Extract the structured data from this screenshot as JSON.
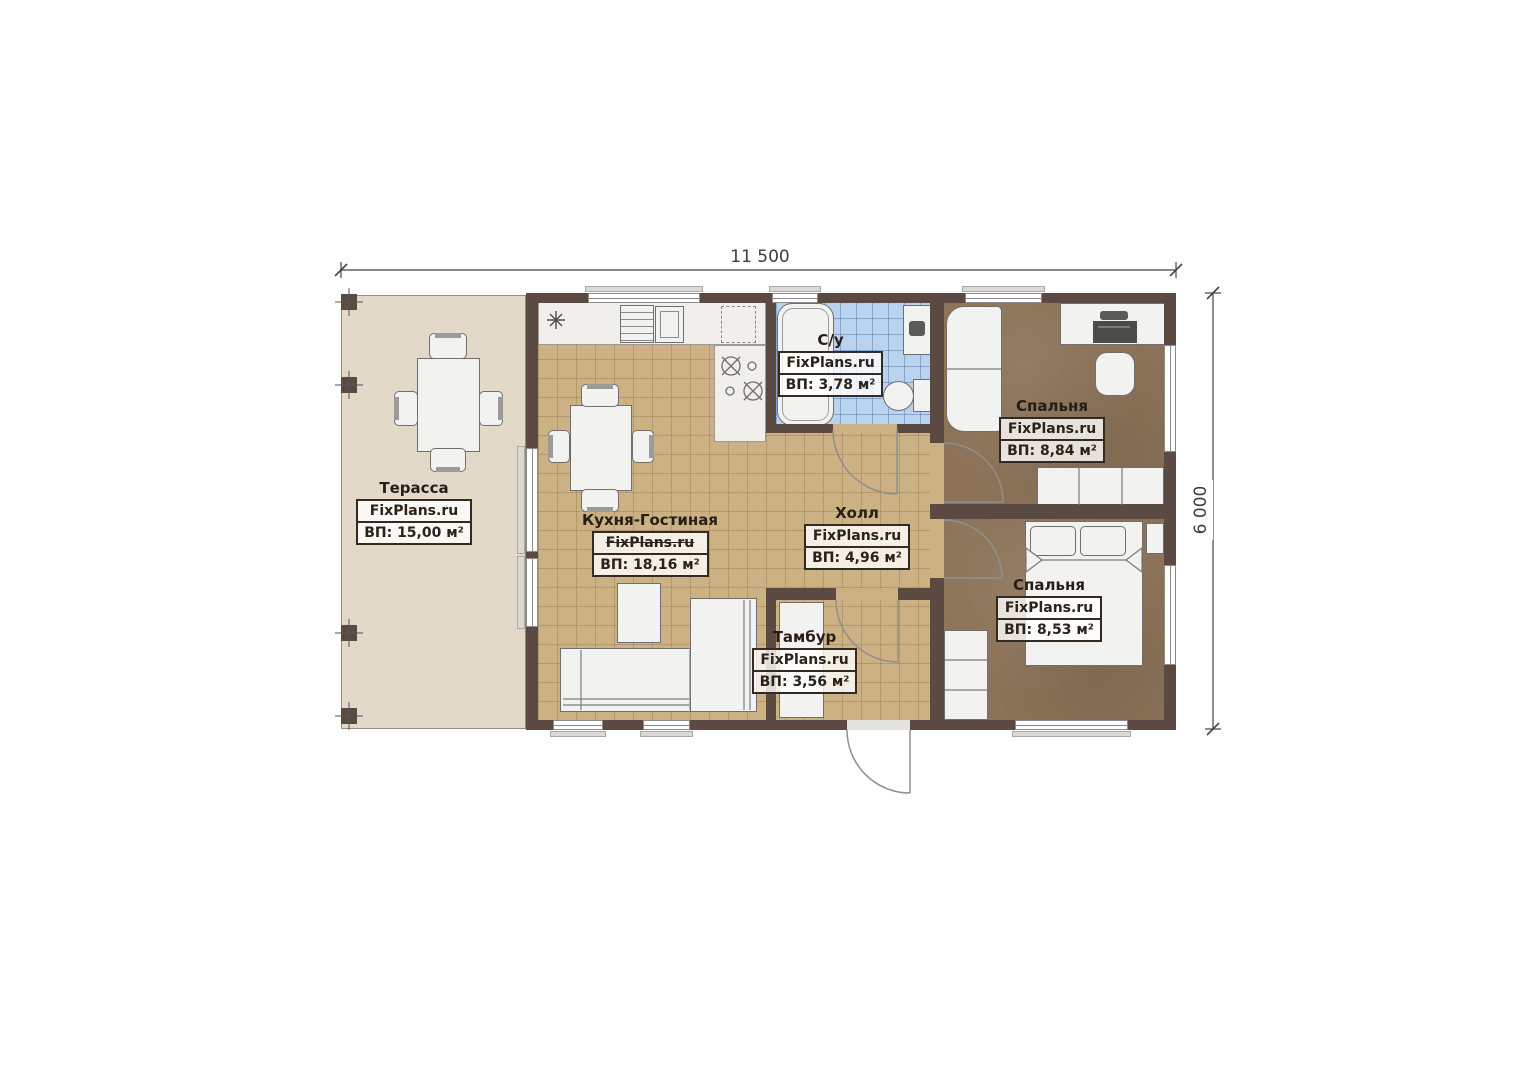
{
  "dimensions": {
    "width": "11 500",
    "height": "6 000"
  },
  "watermark": "FixPlans.ru",
  "rooms": [
    {
      "key": "terrace",
      "name": "Терасса",
      "watermark": "FixPlans.ru",
      "area": "ВП: 15,00 м²"
    },
    {
      "key": "kitchen-living",
      "name": "Кухня-Гостиная",
      "watermark": "FixPlans.ru",
      "area": "ВП: 18,16 м²"
    },
    {
      "key": "bathroom",
      "name": "С/у",
      "watermark": "FixPlans.ru",
      "area": "ВП: 3,78 м²"
    },
    {
      "key": "hall",
      "name": "Холл",
      "watermark": "FixPlans.ru",
      "area": "ВП: 4,96 м²"
    },
    {
      "key": "bedroom-top",
      "name": "Спальня",
      "watermark": "FixPlans.ru",
      "area": "ВП: 8,84 м²"
    },
    {
      "key": "bedroom-bottom",
      "name": "Спальня",
      "watermark": "FixPlans.ru",
      "area": "ВП: 8,53 м²"
    },
    {
      "key": "vestibule",
      "name": "Тамбур",
      "watermark": "FixPlans.ru",
      "area": "ВП: 3,56 м²"
    }
  ],
  "colors": {
    "wall": "#5b4a42",
    "floor_tile": "#ccb184",
    "terrace_floor": "#e3d9c8",
    "bedroom_floor": "#8b7258",
    "bathroom_tile": "#b9d3ef",
    "label_border": "#332a22"
  }
}
